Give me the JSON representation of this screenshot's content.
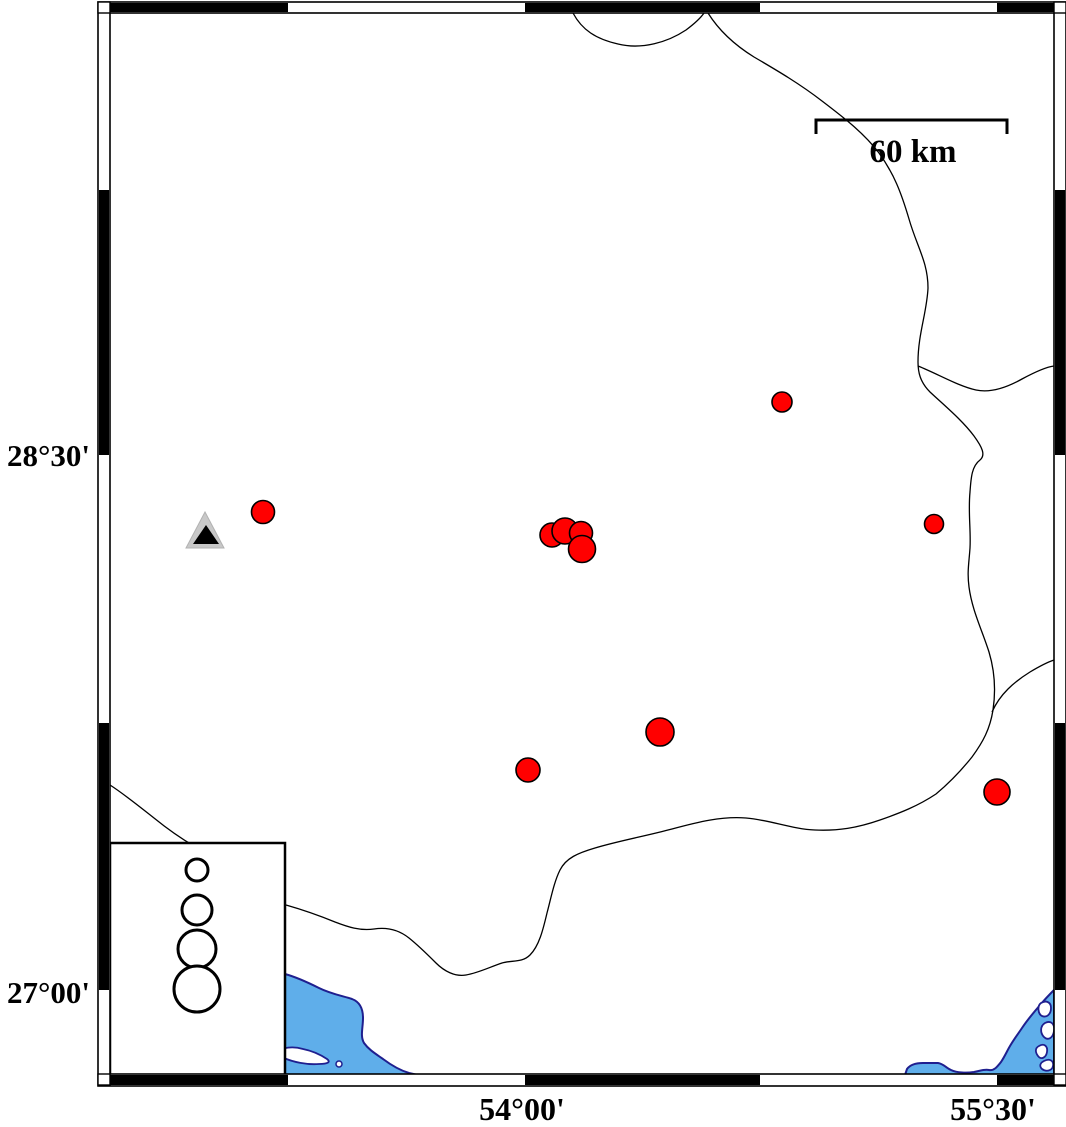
{
  "map": {
    "title_hint": "seismicity map with station and epicenters",
    "colors": {
      "background": "#ffffff",
      "water": "#5FAEEA",
      "coast_outline": "#1f1f8f",
      "epicenter_fill": "#FF0000",
      "epicenter_stroke": "#000000",
      "station_outer_fill": "#C8C8C8",
      "station_inner_fill": "#000000",
      "boundary_line": "#000000",
      "frame_black": "#000000",
      "frame_white": "#ffffff"
    },
    "axis_labels": {
      "left": [
        {
          "text": "28°30'",
          "y": 455
        },
        {
          "text": "27°00'",
          "y": 992
        }
      ],
      "bottom": [
        {
          "text": "54°00'",
          "x": 522
        },
        {
          "text": "55°30'",
          "x": 993
        }
      ]
    },
    "scale_bar": {
      "label": "60 km",
      "x1": 816,
      "x2": 1007,
      "y": 120,
      "tick": 14,
      "label_x": 913,
      "label_y": 162
    },
    "frame": {
      "xo": 98,
      "yo": 2,
      "xo2": 1066,
      "yo2": 1086,
      "xi": 110,
      "yi": 13,
      "xi2": 1054,
      "yi2": 1074,
      "x_ticks": [
        110,
        288,
        525,
        760,
        997,
        1054
      ],
      "y_ticks": [
        13,
        190,
        455,
        723,
        990,
        1074
      ],
      "x_first_black": true,
      "y_first_black": false
    },
    "epicenters": [
      {
        "cx": 782,
        "cy": 402,
        "r": 10
      },
      {
        "cx": 263,
        "cy": 512,
        "r": 11.5
      },
      {
        "cx": 552,
        "cy": 535,
        "r": 12
      },
      {
        "cx": 565,
        "cy": 531,
        "r": 13
      },
      {
        "cx": 581,
        "cy": 533,
        "r": 11.5
      },
      {
        "cx": 582,
        "cy": 549,
        "r": 13.5
      },
      {
        "cx": 934,
        "cy": 524,
        "r": 9.5
      },
      {
        "cx": 660,
        "cy": 732,
        "r": 14
      },
      {
        "cx": 528,
        "cy": 770,
        "r": 12
      },
      {
        "cx": 997,
        "cy": 792,
        "r": 13
      }
    ],
    "station": {
      "outer_points": "205,512 186,548 224,548",
      "inner_points": "206,525 193,544 219,544"
    },
    "legend": {
      "box": {
        "x": 110,
        "y": 843,
        "w": 175,
        "h": 232
      },
      "cx": 197,
      "circles": [
        {
          "cy": 870,
          "r": 11
        },
        {
          "cy": 910,
          "r": 15
        },
        {
          "cy": 949,
          "r": 19
        },
        {
          "cy": 989,
          "r": 23
        }
      ]
    },
    "boundaries": [
      "M 573,13 C 582,30 596,39 618,44 C 642,50 668,42 686,30 C 694,24 700,19 704,13",
      "M 708,13 C 718,29 733,44 754,57 C 778,71 800,84 822,101 C 843,117 864,133 879,153 C 894,174 901,192 909,219 C 917,247 928,262 928,288 C 927,312 918,334 918,362 C 918,372 920,382 930,392 C 945,406 962,420 974,436 C 982,447 986,455 980,460 C 972,466 971,477 970,492 C 968,512 971,530 970,548 C 969,563 967,572 969,587 C 972,610 982,630 989,652 C 995,672 996,690 993,710 C 990,729 983,742 972,757 C 960,772 948,784 936,794 C 918,806 900,813 880,820 C 857,828 838,831 815,830 C 792,829 770,820 746,818 C 722,816 698,822 672,829 C 646,836 618,841 595,848 C 578,853 566,858 560,870 C 554,882 551,898 547,913 C 543,930 539,946 530,955 C 522,963 512,960 502,963 C 490,967 478,973 466,975 C 455,977 444,971 436,963 C 428,955 419,946 409,938 C 399,930 387,927 374,929 C 360,931 348,927 335,922 C 318,915 300,909 286,905",
      "M 918,366 C 938,374 958,386 976,390 C 990,393 1006,388 1022,379 C 1035,372 1046,367 1054,366",
      "M 992,712 C 1000,694 1014,682 1030,672 C 1040,666 1048,662 1054,660",
      "M 110,785 C 124,794 140,807 154,818 C 170,831 182,839 194,846"
    ],
    "water": {
      "polygons": [
        "M 285,974 C 296,977 307,982 319,988 C 331,994 343,996 352,999 C 360,1002 363,1009 363,1018 C 363,1028 360,1036 364,1043 C 369,1050 376,1054 383,1059 C 391,1065 399,1070 409,1073 L 418,1075 L 285,1075 Z",
        "M 905,1075 L 907,1069 C 910,1065 916,1063 923,1063 L 938,1063 C 944,1064 946,1068 951,1070 C 957,1073 967,1073 974,1072 C 980,1071 984,1069 989,1070 C 994,1071 997,1067 1001,1062 C 1005,1056 1007,1051 1010,1046 C 1014,1039 1018,1034 1022,1028 C 1028,1019 1034,1012 1041,1004 C 1046,998 1051,993 1054,990 L 1054,1075 Z"
      ],
      "islands": [
        "M 276,1053 C 282,1047 293,1046 303,1049 C 313,1051 321,1055 327,1059 C 331,1062 328,1064 319,1064 C 307,1065 293,1062 284,1058 C 278,1056 274,1056 276,1053 Z",
        "M 1041,1003 C 1046,1000 1051,1002 1051,1008 C 1051,1014 1047,1018 1042,1016 C 1038,1014 1037,1006 1041,1003 Z",
        "M 1045,1023 C 1051,1020 1055,1024 1054,1031 C 1053,1038 1048,1041 1044,1037 C 1040,1033 1040,1026 1045,1023 Z",
        "M 1039,1046 C 1044,1043 1048,1046 1047,1052 C 1046,1058 1041,1060 1038,1056 C 1035,1052 1035,1048 1039,1046 Z",
        "M 1044,1061 C 1050,1058 1054,1061 1053,1066 C 1052,1071 1046,1072 1042,1069 C 1039,1066 1040,1063 1044,1061 Z"
      ],
      "islets": [
        {
          "cx": 339,
          "cy": 1064,
          "r": 3
        }
      ]
    }
  }
}
